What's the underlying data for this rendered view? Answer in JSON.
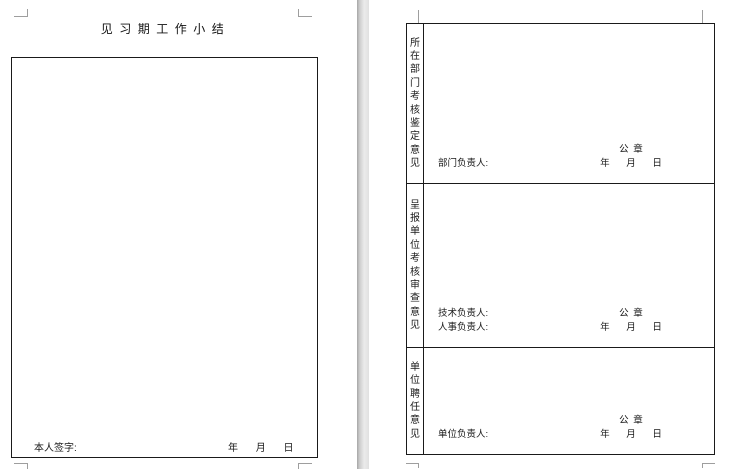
{
  "document": {
    "page1": {
      "title": "见习期工作小结",
      "signature_label": "本人签字:",
      "date_line": "年 月 日"
    },
    "page2": {
      "rows": [
        {
          "side_label": "所在部门考核鉴定意见",
          "person_line1": "",
          "person_line2": "部门负责人:",
          "seal": "公 章",
          "date": "年 月 日"
        },
        {
          "side_label": "呈报单位考核审查意见",
          "person_line1": "技术负责人:",
          "person_line2": "人事负责人:",
          "seal": "公 章",
          "date": "年 月 日"
        },
        {
          "side_label": "单位聘任意见",
          "person_line1": "",
          "person_line2": "单位负责人:",
          "seal": "公 章",
          "date": "年 月 日"
        }
      ]
    },
    "colors": {
      "border": "#1a1a1a",
      "margin_mark": "#9e9e9e",
      "page_gap": "#d6d6d6",
      "page_bg": "#ffffff"
    }
  }
}
